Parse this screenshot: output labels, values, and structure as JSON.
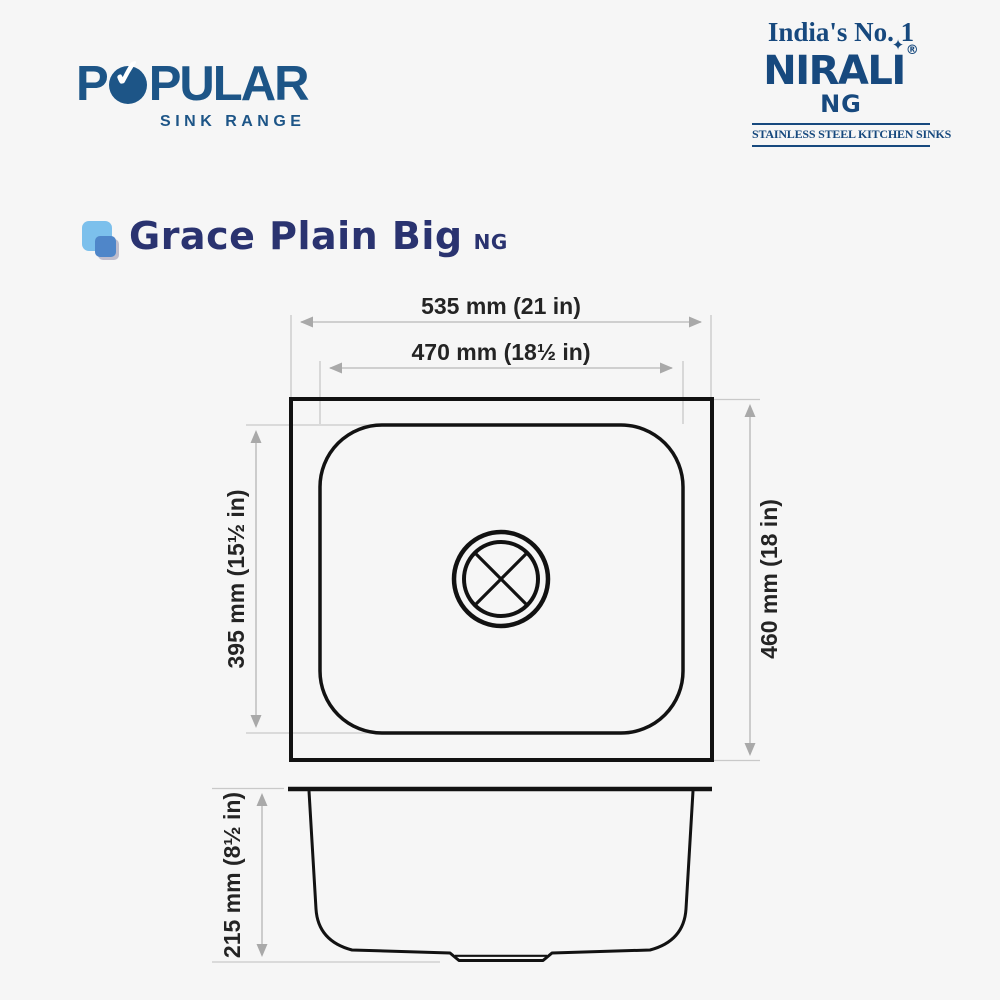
{
  "colors": {
    "background": "#f6f6f6",
    "popular_blue": "#1d5587",
    "nirali_navy": "#17497e",
    "title_indigo": "#2a3370",
    "icon_light_blue": "#7cc0ec",
    "icon_mid_blue": "#4f86c9",
    "drawing_line": "#121212",
    "dimension_gray": "#a9a9a9",
    "dimension_text": "#242424"
  },
  "header": {
    "popular": {
      "prefix": "P",
      "check_glyph": "✓",
      "suffix": "PULAR",
      "subtitle": "SINK RANGE"
    },
    "nirali": {
      "tagline": "India's No. 1",
      "brand_main": "NIRAL",
      "brand_last": "I",
      "star_glyph": "✦",
      "registered_mark": "®",
      "sub_brand": "NG",
      "strapline": "STAINLESS STEEL KITCHEN SINKS"
    }
  },
  "product": {
    "name": "Grace Plain Big",
    "series": "NG"
  },
  "diagram": {
    "top_view": {
      "outer_width": "535 mm (21 in)",
      "inner_width": "470 mm (18½ in)",
      "inner_length": "395 mm (15½ in)",
      "outer_length": "460 mm (18 in)"
    },
    "side_view": {
      "depth": "215 mm (8½ in)"
    }
  }
}
